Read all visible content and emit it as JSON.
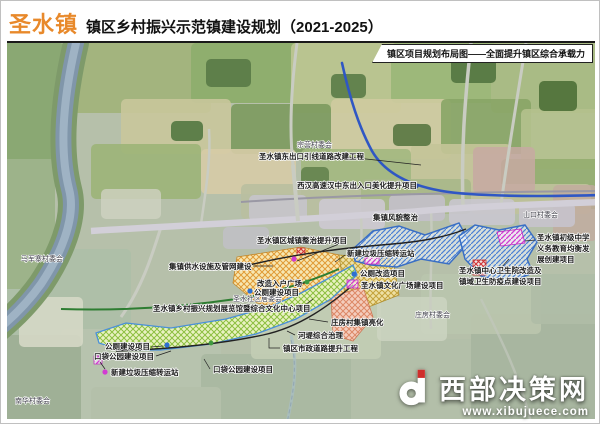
{
  "header": {
    "town": "圣水镇",
    "title": "镇区乡村振兴示范镇建设规划（2021-2025）",
    "ribbon": "镇区项目规划布局图——全面提升镇区综合承载力"
  },
  "map": {
    "villages": {
      "zongying": "宗营村委会",
      "shankou": "山口村委会",
      "majunzhai": "马军寨村委会",
      "shengshui_shequ": "圣水社区居委会",
      "zhuangfang": "庄房村委会",
      "nanhua": "南华村委会"
    },
    "projects": {
      "dongchukou": "圣水镇东出口引线道路改建工程",
      "gaosu": "西汉高速汉中东出入口美化提升项目",
      "fengmao": "集镇风貌整治",
      "zhengzhi": "圣水镇区城镇整治提升项目",
      "laji_center": "新建垃圾压缩转运站",
      "gongce_gaizao": "公厕改造项目",
      "wenhua": "圣水镇文化广场建设项目",
      "ruhu": "改造入户广场",
      "gongce_center": "公厕建设项目",
      "zhanlanguan": "圣水镇乡村振兴规划展览馆暨综合文化中心项目",
      "weishengyuan_1": "圣水镇中心卫生院改造及",
      "weishengyuan_2": "镇域卫生防疫点建设项目",
      "zhongxue_1": "圣水镇初级中学",
      "zhongxue_2": "义务教育均衡发",
      "zhongxue_3": "展创建项目",
      "gongshui": "集镇供水设施及管网建设",
      "lianghua": "庄房村集镇亮化",
      "hedi": "河堤综合治理",
      "shizheng": "镇区市政道路提升工程",
      "gongce_left": "公厕建设项目",
      "koudai_left": "口袋公园建设项目",
      "laji_left": "新建垃圾压缩转运站",
      "koudai_right": "口袋公园建设项目"
    }
  },
  "watermark": {
    "name": "西部决策网",
    "url": "www.xibujuece.com"
  },
  "colors": {
    "accent_orange": "#e8892b",
    "expressway_blue": "#2f57c4",
    "zone_outline_blue": "#3a6fc4",
    "park_green": "#8cbf3f",
    "town_orange": "#e09a35",
    "magenta": "#d23bd2"
  }
}
